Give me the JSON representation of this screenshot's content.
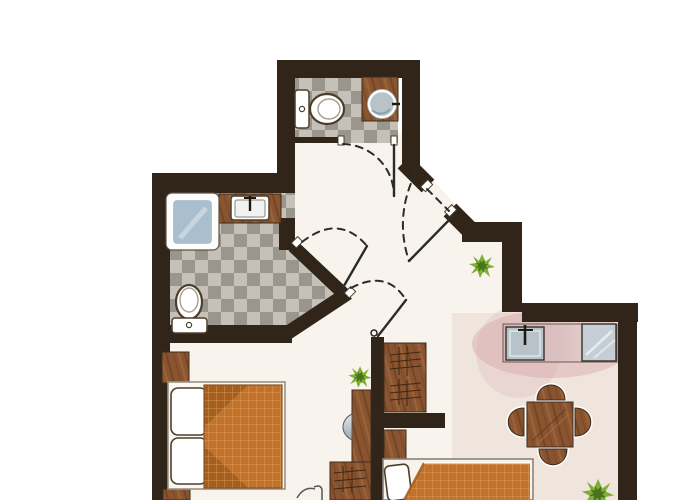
{
  "image_type": "apartment-floor-plan-sketch",
  "visible_text": [],
  "colors": {
    "wall": "#31251a",
    "floor": "#f8f4ed",
    "floor_dining": "#e9ddd2",
    "counter_glow": "#dcaeb0",
    "tile_light": "#c6c1b8",
    "tile_dark": "#9b968d",
    "wood": "#8a5430",
    "wood_light": "#a96f3f",
    "wood_dark": "#5e3a1d",
    "outline": "#3c2b1b",
    "fixture_white": "#ffffff",
    "fixture_outline": "#4d3e2c",
    "shower_blue": "#a9bfcd",
    "sink_gray": "#b7c3c9",
    "glass_gray": "#c5ced4",
    "counter_pink_1": "#d9b6ba",
    "counter_pink_2": "#efdfd8",
    "blanket": "#c1722d",
    "blanket_dark": "#9e5a1e",
    "blanket_grid": "#e0a05c",
    "plant": "#7fae34",
    "plant_dark": "#47731c",
    "door_line": "#2b2b2b",
    "frame_gray": "#9a9186"
  },
  "floorplan": {
    "rooms": [
      {
        "name": "bathroom-top",
        "floor": "gray-checker-tile",
        "fixtures": [
          "toilet",
          "wood-counter",
          "round-washbasin",
          "door-swing"
        ]
      },
      {
        "name": "bathroom-left",
        "floor": "gray-checker-tile",
        "fixtures": [
          "shower-cabin",
          "wood-counter",
          "rect-washbasin",
          "toilet",
          "door-swing"
        ]
      },
      {
        "name": "hallway",
        "floor": "cream",
        "fixtures": [
          "entry-door-diagonal",
          "door-swing-arcs",
          "plant"
        ]
      },
      {
        "name": "bedroom",
        "floor": "cream",
        "fixtures": [
          "double-bed",
          "two-pillows",
          "orange-grid-blanket",
          "nightstand",
          "nightstand"
        ]
      },
      {
        "name": "living-dining",
        "floor": "warm-beige",
        "fixtures": [
          "kitchen-counter",
          "kitchen-sink",
          "cooktop",
          "dining-table",
          "chair",
          "chair",
          "chair",
          "chair",
          "wardrobe",
          "tv-panel",
          "small-cabinet",
          "low-cabinet",
          "second-bed",
          "plant",
          "plant"
        ]
      }
    ],
    "wall_style": "thick dark brown",
    "door_style": "dashed swing arcs with solid leaf lines"
  }
}
